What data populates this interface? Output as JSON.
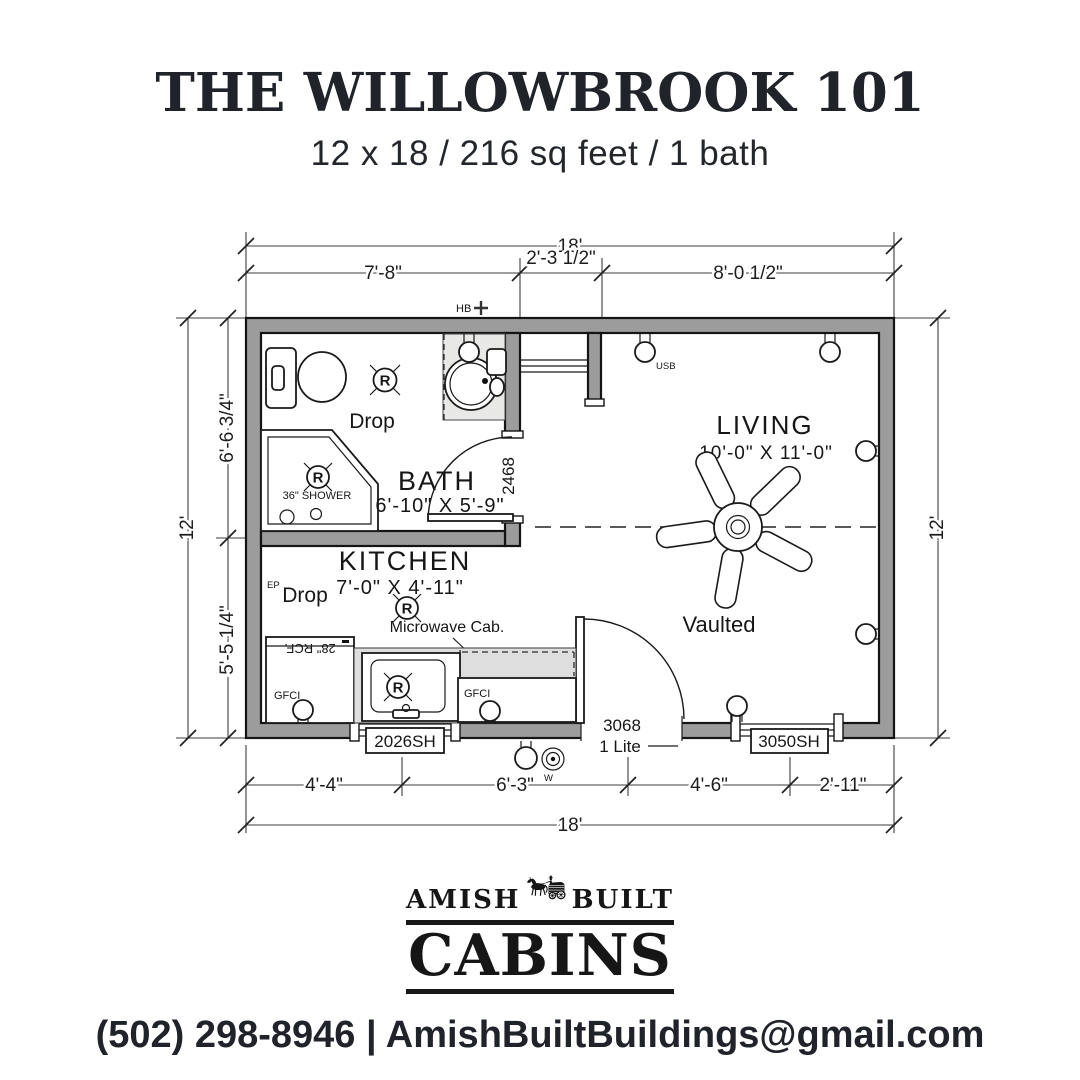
{
  "header": {
    "title": "THE WILLOWBROOK 101",
    "subtitle": "12 x 18 / 216 sq feet / 1 bath"
  },
  "plan": {
    "dim_top": {
      "overall": "18'",
      "segs": [
        "7'-8\"",
        "2'-3 1/2\"",
        "8'-0 1/2\""
      ]
    },
    "dim_bottom": {
      "overall": "18'",
      "segs": [
        "4'-4\"",
        "6'-3\"",
        "4'-6\"",
        "2'-11\""
      ]
    },
    "dim_left": {
      "overall": "12'",
      "segs": [
        "6'-6 3/4\"",
        "5'-5 1/4\""
      ]
    },
    "dim_right": {
      "overall": "12'"
    },
    "bath": {
      "name": "BATH",
      "size": "6'-10\" X 5'-9\"",
      "drop": "Drop",
      "shower": "36\" SHOWER",
      "door": "2468",
      "light": "R"
    },
    "kitchen": {
      "name": "KITCHEN",
      "size": "7'-0\" X 4'-11\"",
      "drop": "Drop",
      "ep": "EP",
      "microwave": "Microwave Cab.",
      "fridge": "28\" RCF.",
      "gfci_left": "GFCI",
      "gfci_right": "GFCI",
      "window": "2026SH",
      "light": "R",
      "sink_light": "R"
    },
    "living": {
      "name": "LIVING",
      "size": "10'-0\" X 11'-0\"",
      "vaulted": "Vaulted",
      "usb": "USB",
      "door_size": "3068",
      "door_lite": "1 Lite",
      "window": "3050SH"
    },
    "exterior": {
      "hose_bib": "HB",
      "water": "W"
    }
  },
  "logo": {
    "amish": "AMISH",
    "built": "BUILT",
    "cabins": "CABINS"
  },
  "footer": {
    "contact": "(502) 298-8946 | AmishBuiltBuildings@gmail.com"
  }
}
